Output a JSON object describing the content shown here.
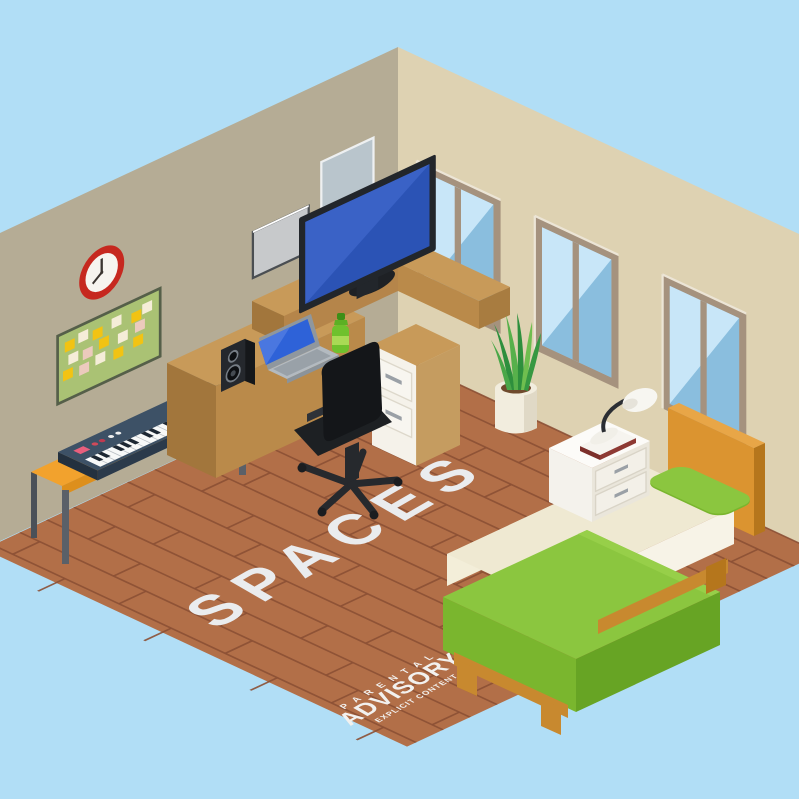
{
  "artwork": {
    "title": "SPACES",
    "style": "isometric-room-illustration"
  },
  "advisory_label": {
    "line1": "P A R E N T A L",
    "line2": "ADVISORY",
    "line3": "EXPLICIT CONTENT"
  },
  "palette": {
    "sky": "#b1def6",
    "left_wall": "#b5ac95",
    "right_wall": "#ded2b2",
    "floor": "#b26f48",
    "floor_lines": "#8c5035",
    "title_text": "#eaecee",
    "desk_wood": "#c89a59",
    "desk_front": "#ba8a4a",
    "monitor_screen": "#2b53b5",
    "laptop_screen": "#2e62d8",
    "blanket_green": "#8bc63f",
    "blanket_side": "#67a424",
    "pillow_green": "#8bc63f",
    "mattress_cream": "#efe9d2",
    "headboard_orange": "#db9430",
    "bench_orange": "#f2a22d",
    "keyboard_body": "#3d5166",
    "clock_ring": "#c6281f",
    "board_green": "#aac274",
    "window_glass": "#a3d2ee",
    "window_frame": "#a5927e",
    "nightstand_white": "#f4f2ec",
    "bottle_green": "#6fc12d",
    "plant_green": "#2e8f3d"
  }
}
